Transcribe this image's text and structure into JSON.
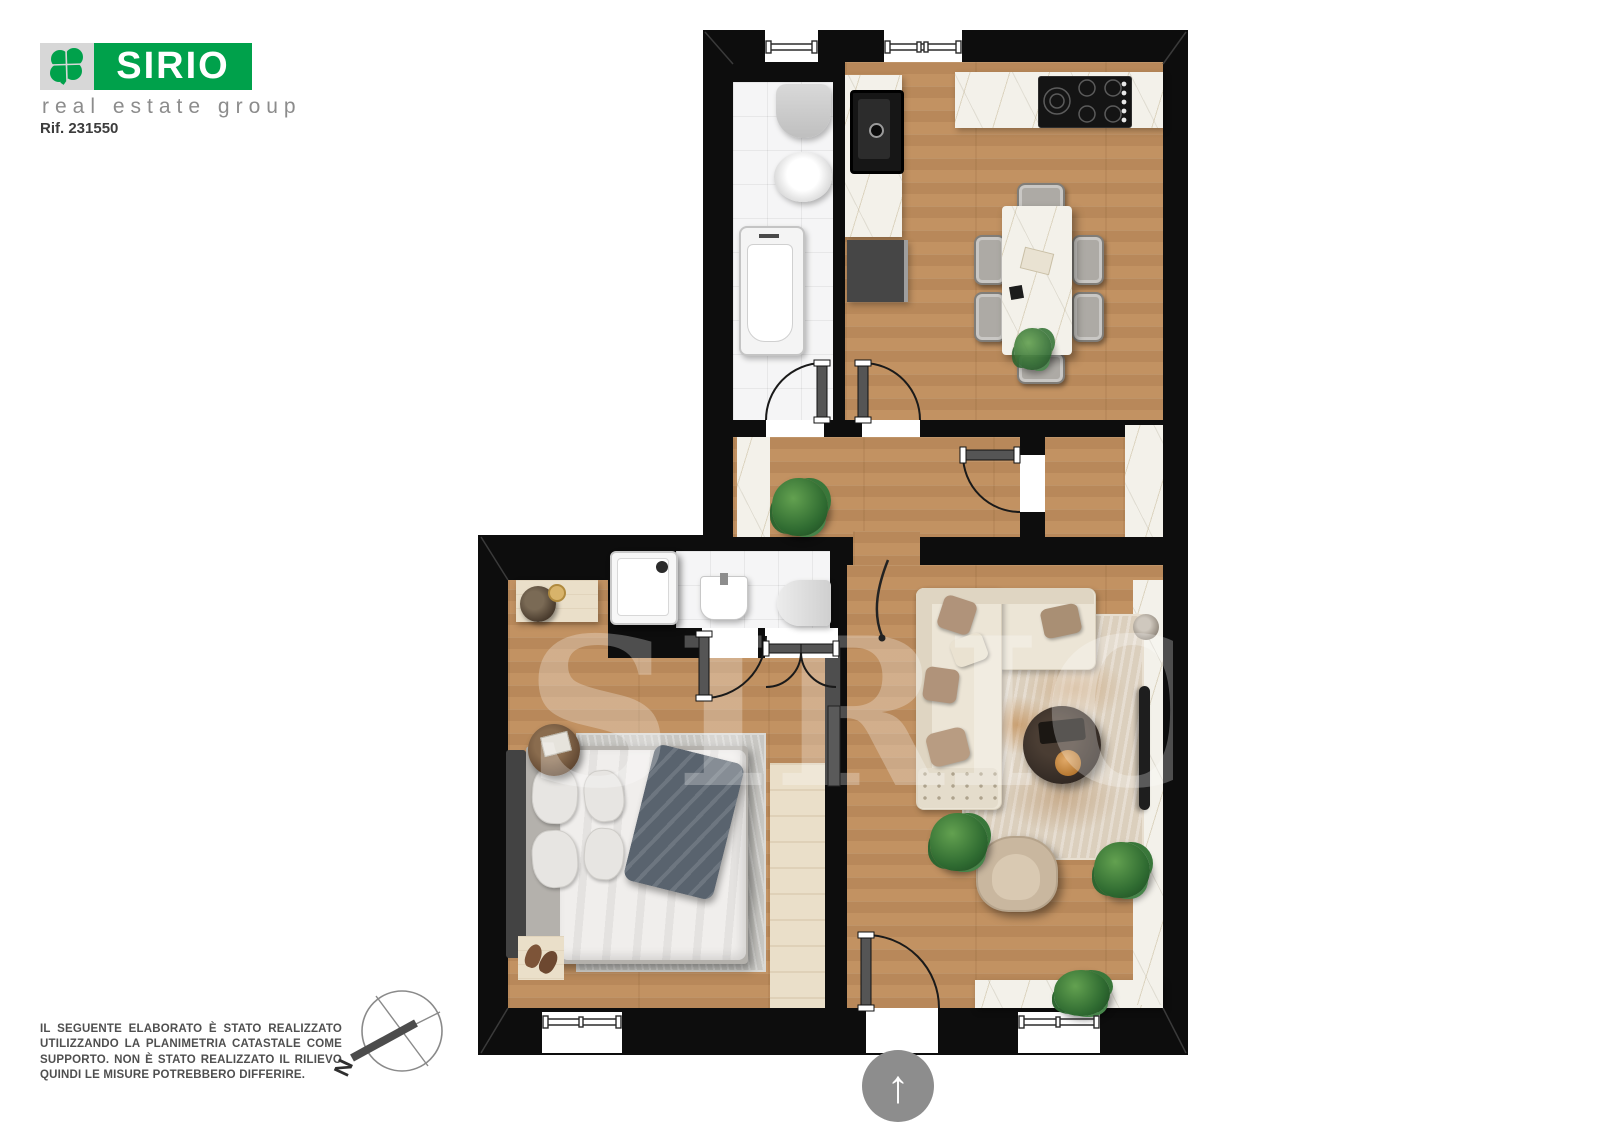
{
  "branding": {
    "name": "SIRIO",
    "tagline": "real estate group"
  },
  "reference": "Rif. 231550",
  "watermark": "SIRIO",
  "compass": {
    "north_label": "N"
  },
  "entrance": {
    "arrow_glyph": "↑"
  },
  "disclaimer": "IL SEGUENTE ELABORATO È STATO REALIZZATO UTILIZZANDO LA PLANIMETRIA CATASTALE COME SUPPORTO. NON È STATO REALIZZATO IL RILIEVO QUINDI LE MISURE POTREBBERO DIFFERIRE.",
  "colors": {
    "brand_green": "#00A14B",
    "logo_grey": "#d7d7d7",
    "tagline_grey": "#8c8c8c",
    "text_dark": "#3c3c3c",
    "wall": "#0d0d0d",
    "wood": "#c49465",
    "wood_pale": "#eadfc9",
    "tile": "#f5f5f6",
    "marble": "#f3f1ea",
    "rug_grey": "#c8c7c3",
    "rug_beige": "#dbcfbd",
    "rust": "#b8792f",
    "sofa_cream": "#ece5d6",
    "pillow_tan": "#b0937a",
    "chair_grey": "#adaaa5",
    "fixture_grey": "#cccccc",
    "dark_appliance": "#1d1d1d",
    "cabinet_grey": "#464646",
    "arrow_circle_grey": "#8d8d8d",
    "door_leaf": "#555555",
    "plant_green": "#3a7a3c",
    "watermark_white": "rgba(255,255,255,0.27)"
  }
}
